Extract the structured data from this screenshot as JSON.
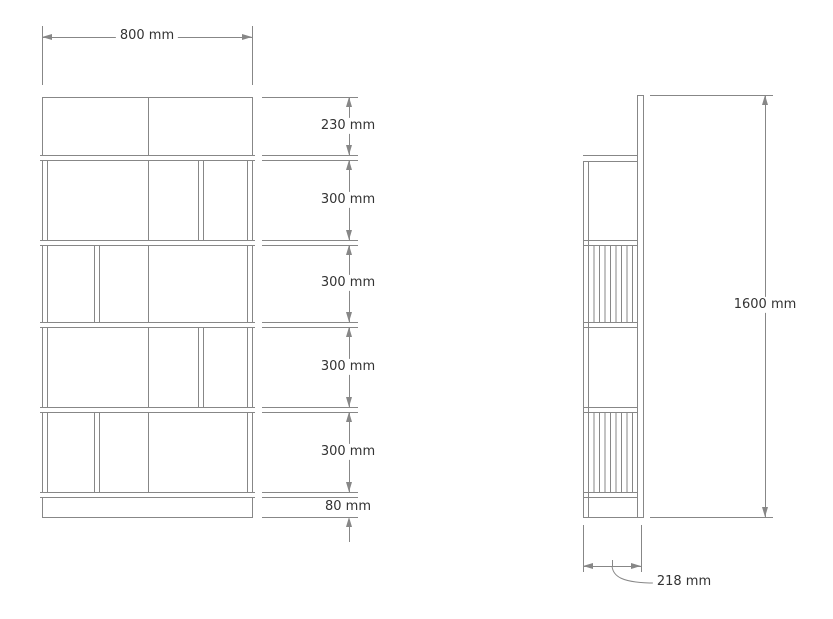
{
  "dimensions": {
    "width": "800 mm",
    "front_heights": [
      "230 mm",
      "300 mm",
      "300 mm",
      "300 mm",
      "300 mm",
      "80 mm"
    ],
    "total_height": "1600 mm",
    "depth": "218 mm"
  },
  "colors": {
    "background": "#ffffff",
    "line": "#878787",
    "text": "#333333"
  }
}
